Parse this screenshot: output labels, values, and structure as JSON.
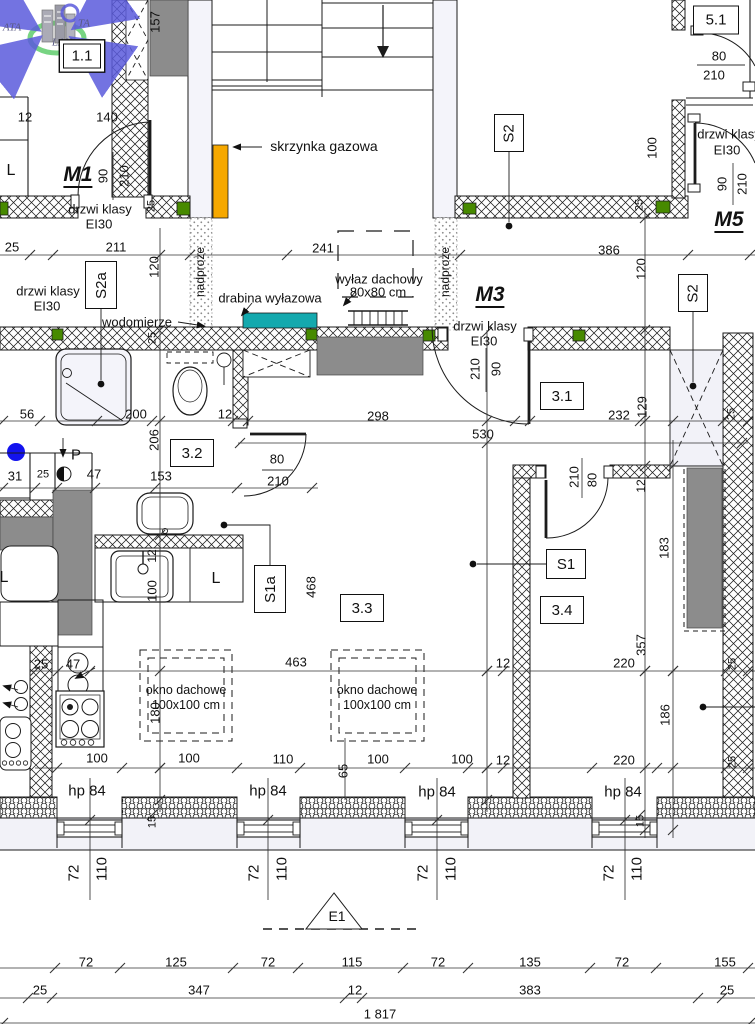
{
  "drawing": {
    "kind": "architectural floor plan (attic storey)",
    "language": "Polish"
  },
  "colors": {
    "line": "#1b1b1b",
    "gas_box_orange": "#F6A800",
    "hatch_teal": "#14A9AE",
    "lintel_green": "#478A00",
    "marker_blue": "#1313EE",
    "block_gray": "#8C8C8C",
    "lavender_fill": "#F2F2F8",
    "logo_blue": "#5B5BDC",
    "logo_green": "#3EC24E"
  },
  "boxed_labels": [
    {
      "n": "room-label-1-1",
      "t": "1.1",
      "x": 82,
      "y": 56,
      "w": 36,
      "h": 23,
      "r": 0,
      "d": 1
    },
    {
      "n": "shaft-label-s2-top",
      "t": "S2",
      "x": 509,
      "y": 133,
      "w": 28,
      "h": 36,
      "r": -90
    },
    {
      "n": "shaft-label-s2a",
      "t": "S2a",
      "x": 101,
      "y": 285,
      "w": 30,
      "h": 46,
      "r": -90
    },
    {
      "n": "shaft-label-s2-right",
      "t": "S2",
      "x": 693,
      "y": 293,
      "w": 28,
      "h": 36,
      "r": -90
    },
    {
      "n": "room-label-3-1",
      "t": "3.1",
      "x": 562,
      "y": 396,
      "w": 42,
      "h": 26,
      "r": 0
    },
    {
      "n": "room-label-3-2",
      "t": "3.2",
      "x": 192,
      "y": 453,
      "w": 42,
      "h": 26,
      "r": 0
    },
    {
      "n": "room-label-3-3",
      "t": "3.3",
      "x": 362,
      "y": 608,
      "w": 42,
      "h": 26,
      "r": 0
    },
    {
      "n": "room-label-3-4",
      "t": "3.4",
      "x": 562,
      "y": 610,
      "w": 42,
      "h": 26,
      "r": 0
    },
    {
      "n": "shaft-label-s1",
      "t": "S1",
      "x": 566,
      "y": 564,
      "w": 38,
      "h": 28,
      "r": 0
    },
    {
      "n": "shaft-label-s1a",
      "t": "S1a",
      "x": 270,
      "y": 589,
      "w": 30,
      "h": 46,
      "r": -90
    },
    {
      "n": "room-label-5-1",
      "t": "5.1",
      "x": 716,
      "y": 20,
      "w": 44,
      "h": 27,
      "r": 0
    }
  ],
  "annotations": [
    {
      "n": "logo-text-ata",
      "t": "ATA",
      "x": 12,
      "y": 28,
      "s": 11,
      "i": 1,
      "f": 1
    },
    {
      "n": "logo-text-ta",
      "t": "TA",
      "x": 84,
      "y": 24,
      "s": 11,
      "i": 1,
      "f": 1
    },
    {
      "n": "logo-text-lan",
      "t": "LAN",
      "x": 62,
      "y": 43,
      "s": 11,
      "i": 1,
      "f": 1
    },
    {
      "n": "dim-157",
      "t": "157",
      "x": 155,
      "y": 22,
      "r": -90
    },
    {
      "n": "dim-12-top",
      "t": "12",
      "x": 25,
      "y": 117
    },
    {
      "n": "dim-140",
      "t": "140",
      "x": 107,
      "y": 117
    },
    {
      "n": "label-l-top",
      "t": "L",
      "x": 11,
      "y": 171,
      "s": 16
    },
    {
      "n": "door-label-m1",
      "t": "M1",
      "x": 78,
      "y": 176,
      "s": 21,
      "b": 1,
      "i": 1,
      "u": 1
    },
    {
      "n": "dim-90-m1",
      "t": "90",
      "x": 103,
      "y": 176,
      "r": -90
    },
    {
      "n": "dim-210-m1",
      "t": "210",
      "x": 124,
      "y": 176,
      "r": -90
    },
    {
      "n": "dim-25-m1-wall",
      "t": "25",
      "x": 152,
      "y": 206,
      "r": -90,
      "s": 11
    },
    {
      "n": "label-drzwi-m1-1",
      "t": "drzwi klasy",
      "x": 100,
      "y": 209
    },
    {
      "n": "label-drzwi-m1-2",
      "t": "EI30",
      "x": 99,
      "y": 224
    },
    {
      "n": "label-skrzynka-gazowa",
      "t": "skrzynka gazowa",
      "x": 324,
      "y": 146,
      "s": 14
    },
    {
      "n": "label-drzwi-m5-1",
      "t": "drzwi klasy",
      "x": 729,
      "y": 134
    },
    {
      "n": "label-drzwi-m5-2",
      "t": "EI30",
      "x": 727,
      "y": 150
    },
    {
      "n": "dim-100-m5",
      "t": "100",
      "x": 652,
      "y": 148,
      "r": -90
    },
    {
      "n": "dim-90-m5",
      "t": "90",
      "x": 722,
      "y": 184,
      "r": -90
    },
    {
      "n": "dim-210-m5",
      "t": "210",
      "x": 742,
      "y": 184,
      "r": -90
    },
    {
      "n": "dim-25-m5-wall",
      "t": "25",
      "x": 640,
      "y": 205,
      "r": -90,
      "s": 11
    },
    {
      "n": "door-label-m5",
      "t": "M5",
      "x": 729,
      "y": 221,
      "s": 21,
      "b": 1,
      "i": 1,
      "u": 1
    },
    {
      "n": "dim-80-51",
      "t": "80",
      "x": 719,
      "y": 56
    },
    {
      "n": "dim-210-51",
      "t": "210",
      "x": 714,
      "y": 75
    },
    {
      "n": "dim-25-row2-left",
      "t": "25",
      "x": 12,
      "y": 247
    },
    {
      "n": "dim-211",
      "t": "211",
      "x": 116,
      "y": 247
    },
    {
      "n": "dim-241",
      "t": "241",
      "x": 323,
      "y": 248
    },
    {
      "n": "dim-386",
      "t": "386",
      "x": 609,
      "y": 250
    },
    {
      "n": "dim-120-left",
      "t": "120",
      "x": 154,
      "y": 267,
      "r": -90
    },
    {
      "n": "dim-120-right",
      "t": "120",
      "x": 641,
      "y": 269,
      "r": -90
    },
    {
      "n": "label-nadproze-left",
      "t": "nadproże",
      "x": 200,
      "y": 272,
      "r": -90,
      "s": 12
    },
    {
      "n": "label-nadproze-right",
      "t": "nadproże",
      "x": 445,
      "y": 272,
      "r": -90,
      "s": 12
    },
    {
      "n": "label-drzwi-s2a-1",
      "t": "drzwi klasy",
      "x": 48,
      "y": 291
    },
    {
      "n": "label-drzwi-s2a-2",
      "t": "EI30",
      "x": 47,
      "y": 306
    },
    {
      "n": "label-drabina",
      "t": "drabina wyłazowa",
      "x": 270,
      "y": 298
    },
    {
      "n": "label-wylaz-1",
      "t": "wyłaz dachowy",
      "x": 379,
      "y": 279
    },
    {
      "n": "label-wylaz-2",
      "t": "80x80 cm",
      "x": 378,
      "y": 292
    },
    {
      "n": "door-label-m3",
      "t": "M3",
      "x": 490,
      "y": 296,
      "s": 21,
      "b": 1,
      "i": 1,
      "u": 1
    },
    {
      "n": "label-wodomierze",
      "t": "wodomierze",
      "x": 137,
      "y": 322
    },
    {
      "n": "label-drzwi-m3-1",
      "t": "drzwi klasy",
      "x": 485,
      "y": 326
    },
    {
      "n": "label-drzwi-m3-2",
      "t": "EI30",
      "x": 484,
      "y": 341
    },
    {
      "n": "dim-25-wall-left",
      "t": "25",
      "x": 153,
      "y": 338,
      "r": -90,
      "s": 11
    },
    {
      "n": "dim-210-m3",
      "t": "210",
      "x": 475,
      "y": 369,
      "r": -90
    },
    {
      "n": "dim-90-m3",
      "t": "90",
      "x": 496,
      "y": 369,
      "r": -90
    },
    {
      "n": "dim-56",
      "t": "56",
      "x": 27,
      "y": 414
    },
    {
      "n": "dim-200",
      "t": "200",
      "x": 136,
      "y": 414
    },
    {
      "n": "dim-12-bath",
      "t": "12",
      "x": 225,
      "y": 414
    },
    {
      "n": "dim-232",
      "t": "232",
      "x": 619,
      "y": 415
    },
    {
      "n": "dim-129",
      "t": "129",
      "x": 642,
      "y": 407,
      "r": -90
    },
    {
      "n": "dim-298",
      "t": "298",
      "x": 378,
      "y": 416
    },
    {
      "n": "dim-530",
      "t": "530",
      "x": 483,
      "y": 434
    },
    {
      "n": "dim-25-right-shaft",
      "t": "25",
      "x": 732,
      "y": 414,
      "r": -90,
      "s": 11
    },
    {
      "n": "label-p",
      "t": "P",
      "x": 76,
      "y": 455,
      "s": 15
    },
    {
      "n": "dim-31",
      "t": "31",
      "x": 15,
      "y": 476
    },
    {
      "n": "dim-25-k1",
      "t": "25",
      "x": 43,
      "y": 475,
      "s": 11
    },
    {
      "n": "dim-47-top",
      "t": "47",
      "x": 94,
      "y": 474
    },
    {
      "n": "dim-153",
      "t": "153",
      "x": 161,
      "y": 476
    },
    {
      "n": "dim-80-32",
      "t": "80",
      "x": 277,
      "y": 459
    },
    {
      "n": "dim-210-32",
      "t": "210",
      "x": 278,
      "y": 481
    },
    {
      "n": "dim-206",
      "t": "206",
      "x": 154,
      "y": 440,
      "r": -90
    },
    {
      "n": "dim-210-s1",
      "t": "210",
      "x": 574,
      "y": 477,
      "r": -90
    },
    {
      "n": "dim-80-s1",
      "t": "80",
      "x": 592,
      "y": 480,
      "r": -90
    },
    {
      "n": "dim-12-right-wall",
      "t": "12",
      "x": 641,
      "y": 486,
      "r": -90,
      "s": 12
    },
    {
      "n": "dim-12-sink",
      "t": "12",
      "x": 152,
      "y": 556,
      "r": -90,
      "s": 12
    },
    {
      "n": "dim-100-sink",
      "t": "100",
      "x": 152,
      "y": 591,
      "r": -90
    },
    {
      "n": "label-l-mid",
      "t": "L",
      "x": 4,
      "y": 578,
      "s": 16
    },
    {
      "n": "label-l-kitchen",
      "t": "L",
      "x": 216,
      "y": 579,
      "s": 16
    },
    {
      "n": "dim-468",
      "t": "468",
      "x": 311,
      "y": 587,
      "r": -90
    },
    {
      "n": "dim-183",
      "t": "183",
      "x": 664,
      "y": 548,
      "r": -90
    },
    {
      "n": "dim-357",
      "t": "357",
      "x": 641,
      "y": 645,
      "r": -90
    },
    {
      "n": "dim-186",
      "t": "186",
      "x": 665,
      "y": 715,
      "r": -90
    },
    {
      "n": "dim-25-kitchen",
      "t": "25",
      "x": 41,
      "y": 664
    },
    {
      "n": "dim-47-kitchen",
      "t": "47",
      "x": 73,
      "y": 664
    },
    {
      "n": "dim-463",
      "t": "463",
      "x": 296,
      "y": 662
    },
    {
      "n": "dim-12-mid",
      "t": "12",
      "x": 503,
      "y": 663
    },
    {
      "n": "dim-220-upper",
      "t": "220",
      "x": 624,
      "y": 663
    },
    {
      "n": "dim-25-right-1",
      "t": "25",
      "x": 733,
      "y": 664,
      "r": -90,
      "s": 11
    },
    {
      "n": "label-okno-1a",
      "t": "okno dachowe",
      "x": 186,
      "y": 690,
      "s": 12.5
    },
    {
      "n": "label-okno-1b",
      "t": "100x100 cm",
      "x": 186,
      "y": 705,
      "s": 12.5
    },
    {
      "n": "label-okno-2a",
      "t": "okno dachowe",
      "x": 377,
      "y": 690,
      "s": 12.5
    },
    {
      "n": "label-okno-2b",
      "t": "100x100 cm",
      "x": 377,
      "y": 705,
      "s": 12.5
    },
    {
      "n": "dim-180",
      "t": "180",
      "x": 155,
      "y": 713,
      "r": -90
    },
    {
      "n": "dim-100-a",
      "t": "100",
      "x": 97,
      "y": 758
    },
    {
      "n": "dim-100-b",
      "t": "100",
      "x": 189,
      "y": 758
    },
    {
      "n": "dim-110-mid",
      "t": "110",
      "x": 283,
      "y": 759
    },
    {
      "n": "dim-65",
      "t": "65",
      "x": 343,
      "y": 771,
      "r": -90
    },
    {
      "n": "dim-100-c",
      "t": "100",
      "x": 378,
      "y": 759
    },
    {
      "n": "dim-100-d",
      "t": "100",
      "x": 462,
      "y": 759
    },
    {
      "n": "dim-12-mid-2",
      "t": "12",
      "x": 503,
      "y": 760
    },
    {
      "n": "dim-220-lower",
      "t": "220",
      "x": 624,
      "y": 760
    },
    {
      "n": "dim-25-right-2",
      "t": "25",
      "x": 733,
      "y": 762,
      "r": -90,
      "s": 11
    },
    {
      "n": "label-hp84-1",
      "t": "hp 84",
      "x": 87,
      "y": 791,
      "s": 15
    },
    {
      "n": "label-hp84-2",
      "t": "hp 84",
      "x": 268,
      "y": 791,
      "s": 15
    },
    {
      "n": "label-hp84-3",
      "t": "hp 84",
      "x": 437,
      "y": 792,
      "s": 15
    },
    {
      "n": "label-hp84-4",
      "t": "hp 84",
      "x": 623,
      "y": 792,
      "s": 15
    },
    {
      "n": "dim-15-left",
      "t": "15",
      "x": 153,
      "y": 822,
      "r": -90,
      "s": 11
    },
    {
      "n": "dim-15-right",
      "t": "15",
      "x": 641,
      "y": 821,
      "r": -90,
      "s": 11
    },
    {
      "n": "dim-72-w1",
      "t": "72",
      "x": 74,
      "y": 873,
      "r": -90,
      "s": 15
    },
    {
      "n": "dim-110-w1",
      "t": "110",
      "x": 102,
      "y": 869,
      "r": -90,
      "s": 15
    },
    {
      "n": "dim-72-w2",
      "t": "72",
      "x": 254,
      "y": 873,
      "r": -90,
      "s": 15
    },
    {
      "n": "dim-110-w2",
      "t": "110",
      "x": 282,
      "y": 869,
      "r": -90,
      "s": 15
    },
    {
      "n": "dim-72-w3",
      "t": "72",
      "x": 423,
      "y": 873,
      "r": -90,
      "s": 15
    },
    {
      "n": "dim-110-w3",
      "t": "110",
      "x": 451,
      "y": 869,
      "r": -90,
      "s": 15
    },
    {
      "n": "dim-72-w4",
      "t": "72",
      "x": 609,
      "y": 873,
      "r": -90,
      "s": 15
    },
    {
      "n": "dim-110-w4",
      "t": "110",
      "x": 637,
      "y": 869,
      "r": -90,
      "s": 15
    },
    {
      "n": "label-e1",
      "t": "E1",
      "x": 337,
      "y": 916,
      "s": 14
    },
    {
      "n": "dim-row1-72a",
      "t": "72",
      "x": 86,
      "y": 962
    },
    {
      "n": "dim-row1-125",
      "t": "125",
      "x": 176,
      "y": 962
    },
    {
      "n": "dim-row1-72b",
      "t": "72",
      "x": 268,
      "y": 962
    },
    {
      "n": "dim-row1-115",
      "t": "115",
      "x": 352,
      "y": 962
    },
    {
      "n": "dim-row1-72c",
      "t": "72",
      "x": 438,
      "y": 962
    },
    {
      "n": "dim-row1-135",
      "t": "135",
      "x": 530,
      "y": 962
    },
    {
      "n": "dim-row1-72d",
      "t": "72",
      "x": 622,
      "y": 962
    },
    {
      "n": "dim-row1-155",
      "t": "155",
      "x": 725,
      "y": 962
    },
    {
      "n": "dim-row2-25a",
      "t": "25",
      "x": 40,
      "y": 990
    },
    {
      "n": "dim-row2-347",
      "t": "347",
      "x": 199,
      "y": 990
    },
    {
      "n": "dim-row2-12",
      "t": "12",
      "x": 355,
      "y": 990
    },
    {
      "n": "dim-row2-383",
      "t": "383",
      "x": 530,
      "y": 990
    },
    {
      "n": "dim-row2-25b",
      "t": "25",
      "x": 727,
      "y": 990
    },
    {
      "n": "dim-row3-1817",
      "t": "1 817",
      "x": 380,
      "y": 1014
    }
  ]
}
